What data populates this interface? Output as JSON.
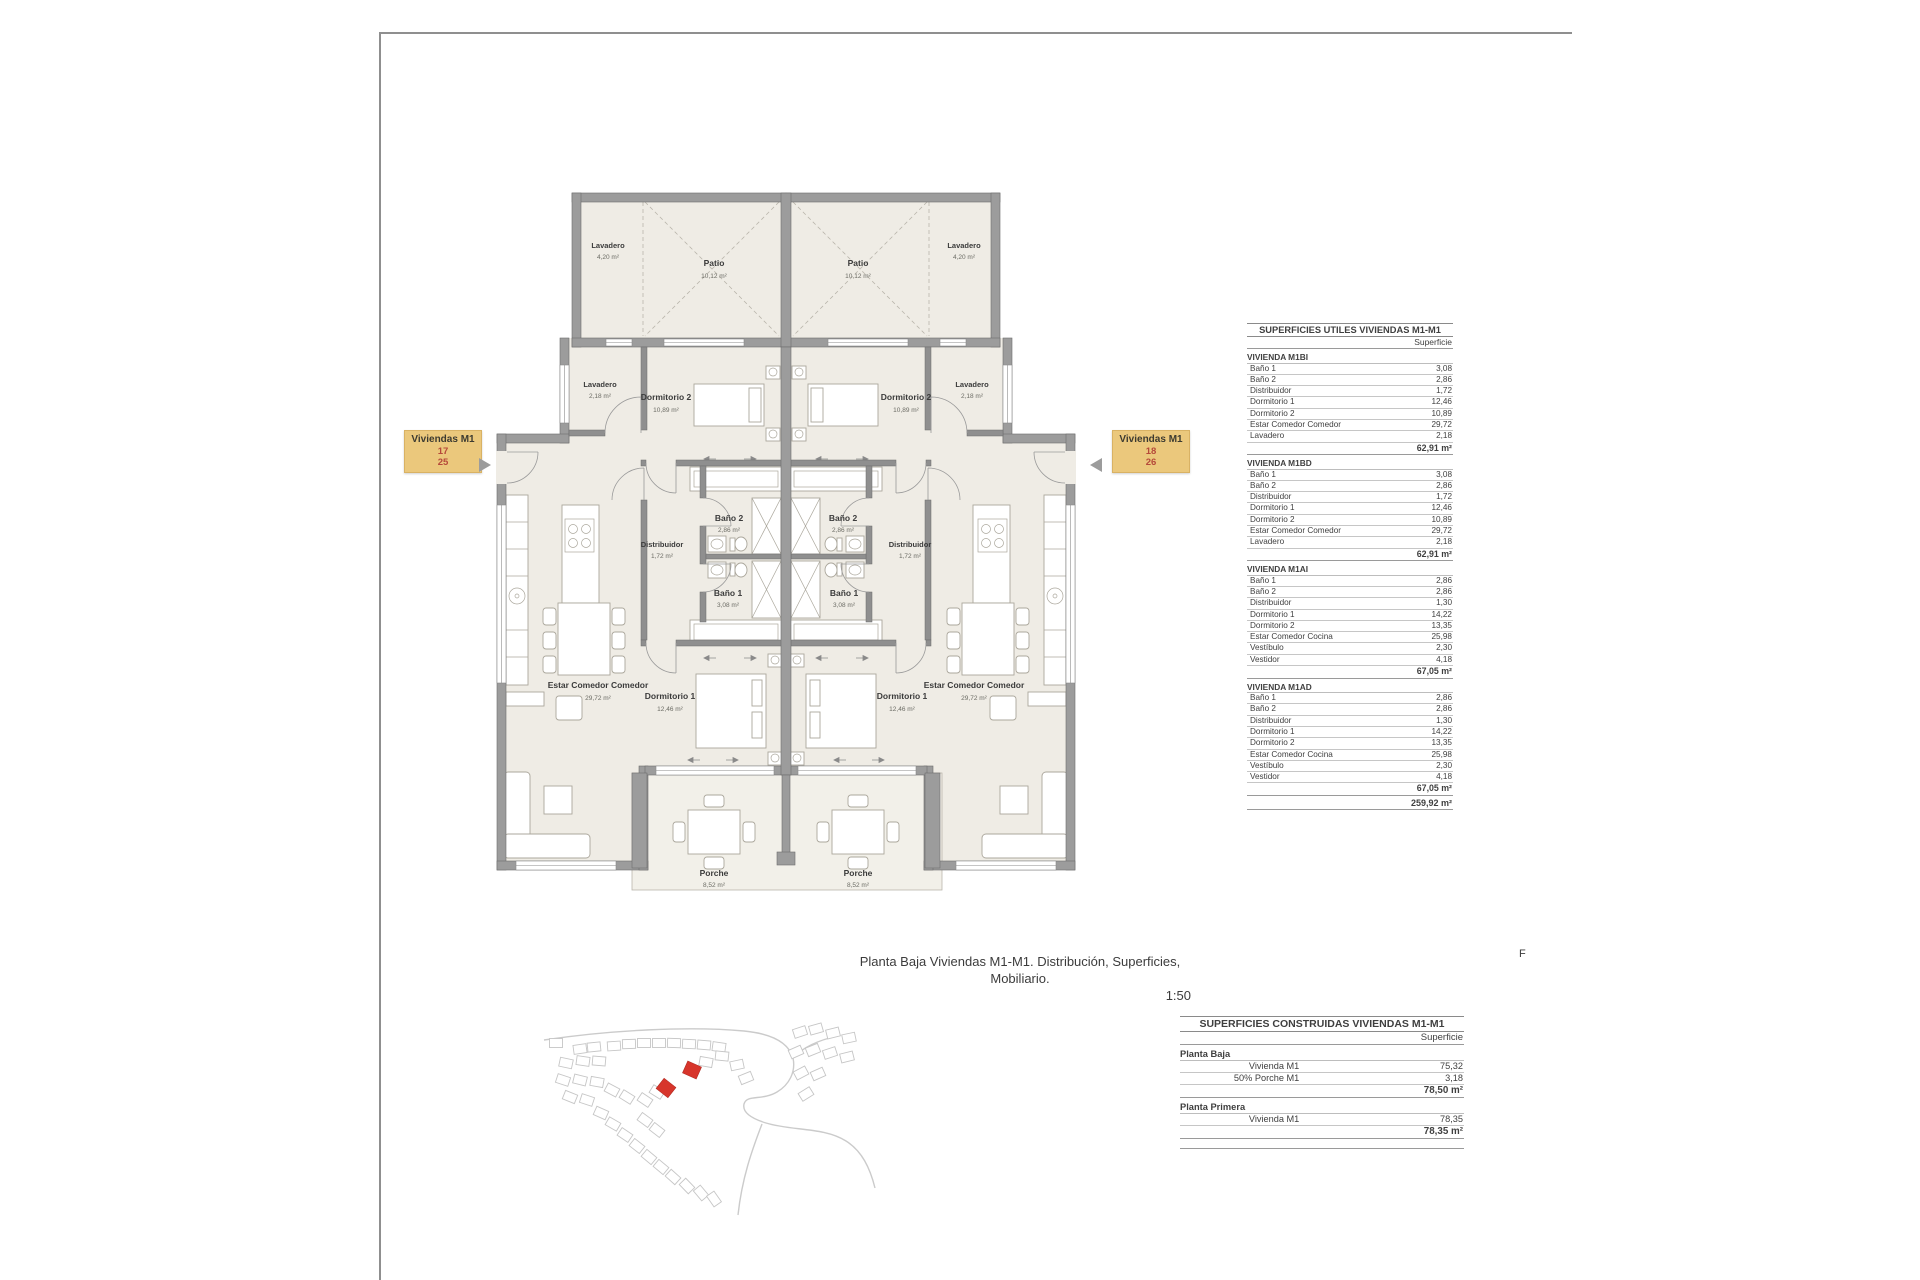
{
  "sheet": {
    "caption_line1": "Planta Baja Viviendas M1-M1. Distribución, Superficies, Mobiliario.",
    "caption_line2": "1:50",
    "corner_mark": "F"
  },
  "tags": {
    "left": {
      "title": "Viviendas M1",
      "num_top": "17",
      "num_bottom": "25"
    },
    "right": {
      "title": "Viviendas M1",
      "num_top": "18",
      "num_bottom": "26"
    }
  },
  "plan": {
    "rooms": {
      "lavadero_patio": {
        "name": "Lavadero",
        "area": "4,20 m²"
      },
      "patio": {
        "name": "Patio",
        "area": "10,12 m²"
      },
      "lavadero": {
        "name": "Lavadero",
        "area": "2,18 m²"
      },
      "dormitorio2": {
        "name": "Dormitorio 2",
        "area": "10,89 m²"
      },
      "bano2": {
        "name": "Baño 2",
        "area": "2,86 m²"
      },
      "distribuidor": {
        "name": "Distribuidor",
        "area": "1,72 m²"
      },
      "bano1": {
        "name": "Baño 1",
        "area": "3,08 m²"
      },
      "dormitorio1": {
        "name": "Dormitorio 1",
        "area": "12,46 m²"
      },
      "estar": {
        "name": "Estar Comedor Comedor",
        "area": "29,72 m²"
      },
      "porche": {
        "name": "Porche",
        "area": "8,52 m²"
      }
    }
  },
  "tables": {
    "utiles": {
      "title": "SUPERFICIES UTILES VIVIENDAS M1-M1",
      "col_header": "Superficie",
      "sections": [
        {
          "name": "VIVIENDA M1BI",
          "rows": [
            [
              "Baño 1",
              "3,08"
            ],
            [
              "Baño 2",
              "2,86"
            ],
            [
              "Distribuidor",
              "1,72"
            ],
            [
              "Dormitorio 1",
              "12,46"
            ],
            [
              "Dormitorio 2",
              "10,89"
            ],
            [
              "Estar Comedor Comedor",
              "29,72"
            ],
            [
              "Lavadero",
              "2,18"
            ]
          ],
          "total": "62,91 m²"
        },
        {
          "name": "VIVIENDA M1BD",
          "rows": [
            [
              "Baño 1",
              "3,08"
            ],
            [
              "Baño 2",
              "2,86"
            ],
            [
              "Distribuidor",
              "1,72"
            ],
            [
              "Dormitorio 1",
              "12,46"
            ],
            [
              "Dormitorio 2",
              "10,89"
            ],
            [
              "Estar Comedor Comedor",
              "29,72"
            ],
            [
              "Lavadero",
              "2,18"
            ]
          ],
          "total": "62,91 m²"
        },
        {
          "name": "VIVIENDA M1AI",
          "rows": [
            [
              "Baño 1",
              "2,86"
            ],
            [
              "Baño 2",
              "2,86"
            ],
            [
              "Distribuidor",
              "1,30"
            ],
            [
              "Dormitorio 1",
              "14,22"
            ],
            [
              "Dormitorio 2",
              "13,35"
            ],
            [
              "Estar Comedor Cocina",
              "25,98"
            ],
            [
              "Vestíbulo",
              "2,30"
            ],
            [
              "Vestidor",
              "4,18"
            ]
          ],
          "total": "67,05 m²"
        },
        {
          "name": "VIVIENDA M1AD",
          "rows": [
            [
              "Baño 1",
              "2,86"
            ],
            [
              "Baño 2",
              "2,86"
            ],
            [
              "Distribuidor",
              "1,30"
            ],
            [
              "Dormitorio 1",
              "14,22"
            ],
            [
              "Dormitorio 2",
              "13,35"
            ],
            [
              "Estar Comedor Cocina",
              "25,98"
            ],
            [
              "Vestíbulo",
              "2,30"
            ],
            [
              "Vestidor",
              "4,18"
            ]
          ],
          "total": "67,05 m²"
        }
      ],
      "grand_total": "259,92 m²"
    },
    "construidas": {
      "title": "SUPERFICIES CONSTRUIDAS VIVIENDAS M1-M1",
      "col_header": "Superficie",
      "sections": [
        {
          "name": "Planta Baja",
          "rows": [
            [
              "Vivienda M1",
              "75,32"
            ],
            [
              "50% Porche M1",
              "3,18"
            ]
          ],
          "total": "78,50 m²"
        },
        {
          "name": "Planta Primera",
          "rows": [
            [
              "Vivienda M1",
              "78,35"
            ]
          ],
          "total": "78,35 m²"
        }
      ]
    }
  }
}
